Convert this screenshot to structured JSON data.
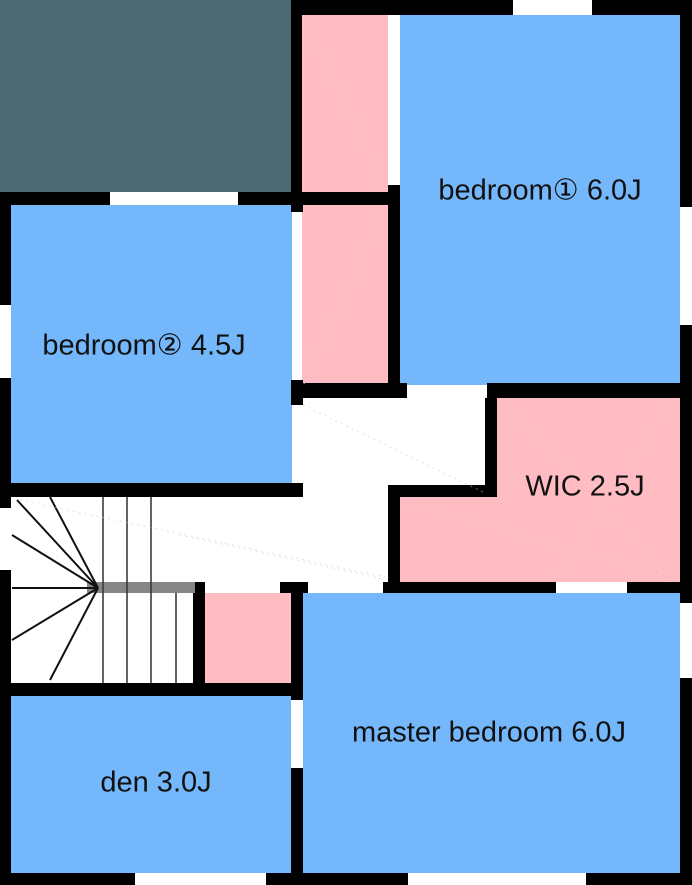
{
  "title": "second floor plan",
  "colors": {
    "room": "#74b8fb",
    "closet": "#ffbdc3",
    "void": "#4c6a73",
    "wall": "#000000",
    "handrail": "#858585",
    "floor": "#ffffff",
    "label": "#111111"
  },
  "rooms": {
    "bedroom1": {
      "label": "bedroom① 6.0J"
    },
    "bedroom2": {
      "label": "bedroom② 4.5J"
    },
    "wic": {
      "label": "WIC 2.5J"
    },
    "master": {
      "label": "master bedroom 6.0J"
    },
    "den": {
      "label": "den 3.0J"
    }
  }
}
